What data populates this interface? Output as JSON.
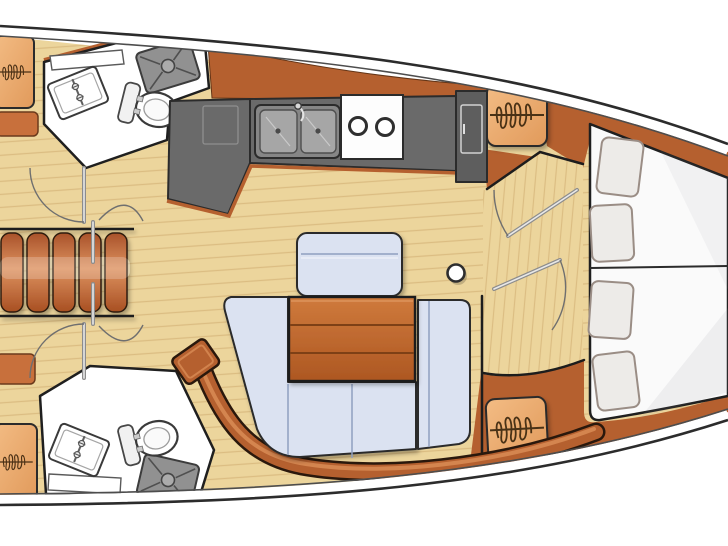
{
  "diagram": {
    "type": "boat-interior-floor-plan",
    "subject": "Sailing yacht interior layout, plan view; bow pointing right, stern cropped at left edge; no text labels rendered in the drawing",
    "colors": {
      "background": "#ffffff",
      "hull_line": "#2c2c2c",
      "hull_inner_line": "#4d4d4d",
      "floor": "#ecd59c",
      "plank_line": "#cdaa6c",
      "wood": "#b5602f",
      "wood_light": "#d98c55",
      "locker_wood": "#efb277",
      "locker_glyph": "#4a3015",
      "counter": "#6a6a6a",
      "appliance": "#5e5e5e",
      "stainless": "#a6a6a6",
      "cushion": "#dbe2f1",
      "cushion_seam": "#8fa0c0",
      "table_wood": "#c06a32",
      "berth": "#fafafa",
      "pillow": "#edebe8",
      "pillow_edge": "#9a8d85",
      "steps_wood": "#c4713c",
      "orange_panel": "#c8703c",
      "fixture_white": "#ffffff",
      "outline": "#1f1f1f"
    },
    "regions": [
      {
        "id": "aft-head-port",
        "label": "Aft head / bathroom (top left)",
        "features": [
          "vanity sink",
          "toilet",
          "shower drain grate",
          "counter strip",
          "door"
        ]
      },
      {
        "id": "aft-head-starboard",
        "label": "Aft head / bathroom (bottom left)",
        "features": [
          "vanity sink",
          "toilet",
          "shower drain grate",
          "counter strip",
          "door"
        ]
      },
      {
        "id": "companionway",
        "label": "Companionway steps (left edge)",
        "features": [
          "5 wooden treads",
          "doors to aft cabins"
        ]
      },
      {
        "id": "galley",
        "label": "Galley (top center)",
        "features": [
          "double stainless sink with faucet",
          "two-burner stove",
          "refrigerator with door",
          "gray countertop",
          "cabinet front"
        ]
      },
      {
        "id": "salon",
        "label": "Salon (center)",
        "features": [
          "U-shaped settee with blue cushions",
          "wood dining table",
          "bench seat with backrest",
          "mast post",
          "plank floor"
        ]
      },
      {
        "id": "bow-vestibule",
        "label": "Bow cabin entry (two swing doors)",
        "features": [
          "double doors",
          "hanging lockers"
        ]
      },
      {
        "id": "bow-cabin",
        "label": "Bow cabin V-berth (right)",
        "features": [
          "island mattress",
          "center seam",
          "4 pillows",
          "wood trim wedges"
        ]
      }
    ],
    "fixture_counts": {
      "pillows": 4,
      "hanging_lockers": 4,
      "door_swings": 6,
      "companionway_steps": 5,
      "stove_burners": 2,
      "galley_sink_basins": 2,
      "toilets": 2,
      "bathroom_sinks": 2,
      "shower_grates": 2,
      "mast_posts": 1
    },
    "legend_symbols": {
      "hanging_locker": "light wood square with looping coil scribble over a horizontal line",
      "door_swing": "thin metallic leaf with quarter-circle arc",
      "shower_grate": "gray rounded rectangle, corner-to-center diagonals, center circle"
    }
  }
}
